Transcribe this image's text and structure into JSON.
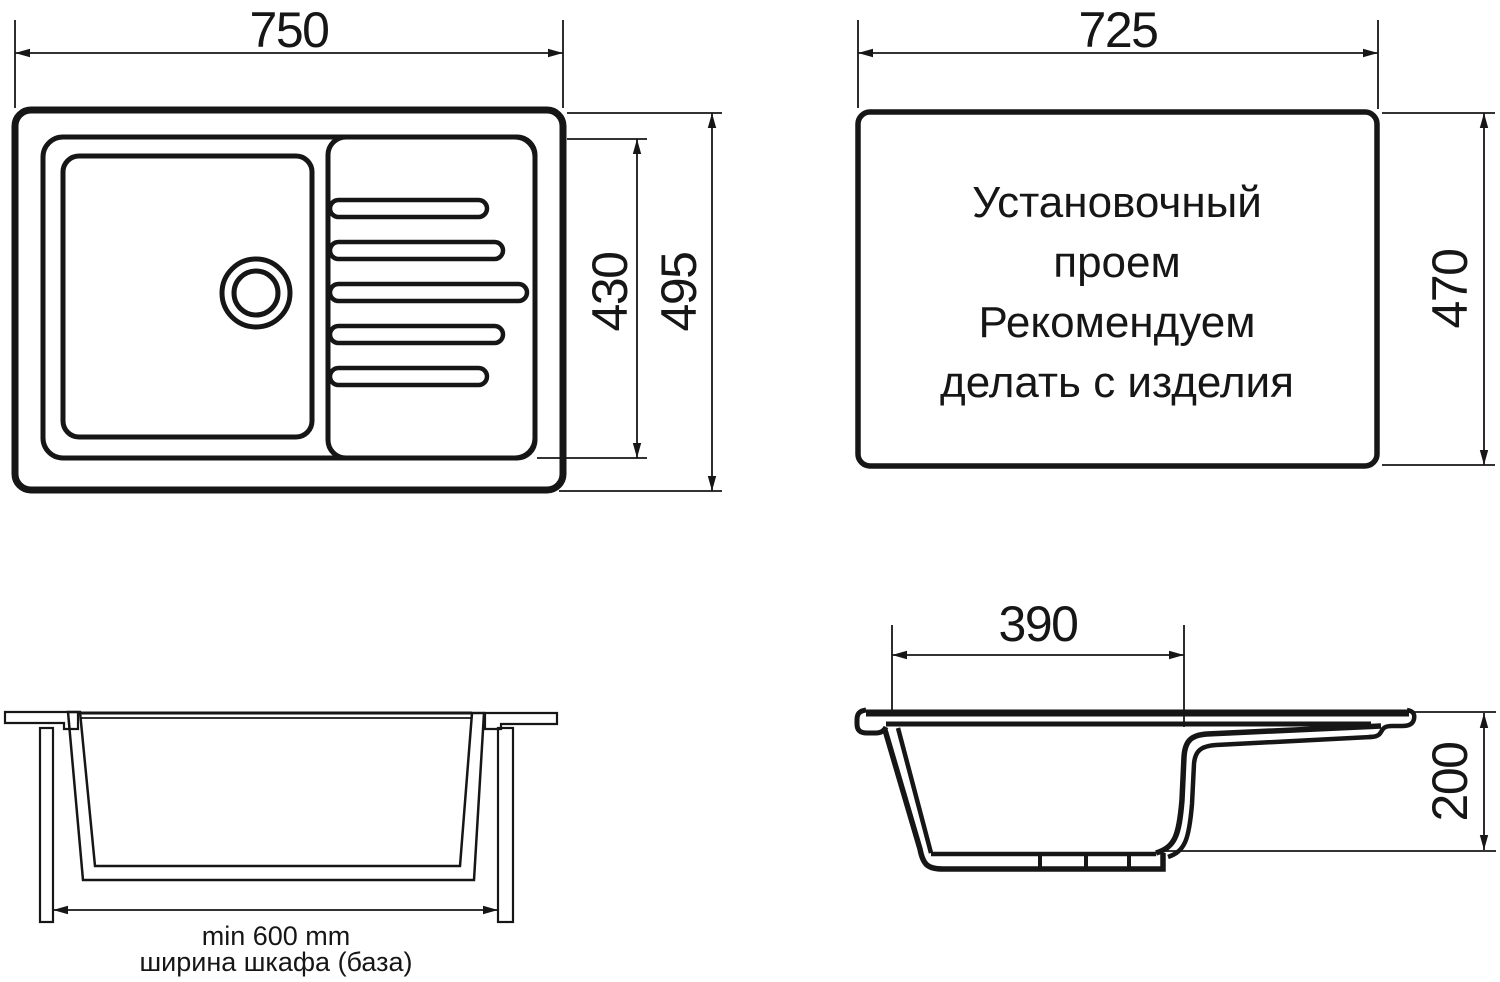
{
  "drawing": {
    "top_view": {
      "width_label": "750",
      "bowl_zone_height_label": "430",
      "total_height_label": "495"
    },
    "cutout_view": {
      "width_label": "725",
      "height_label": "470",
      "note_lines": [
        "Установочный",
        "проем",
        "Рекомендуем",
        "делать с изделия"
      ]
    },
    "cabinet_section": {
      "min_width_label": "min 600 mm",
      "caption": "ширина шкафа (база)"
    },
    "profile_view": {
      "bowl_width_label": "390",
      "depth_label": "200"
    }
  },
  "colors": {
    "line": "#161616",
    "background": "#ffffff"
  }
}
